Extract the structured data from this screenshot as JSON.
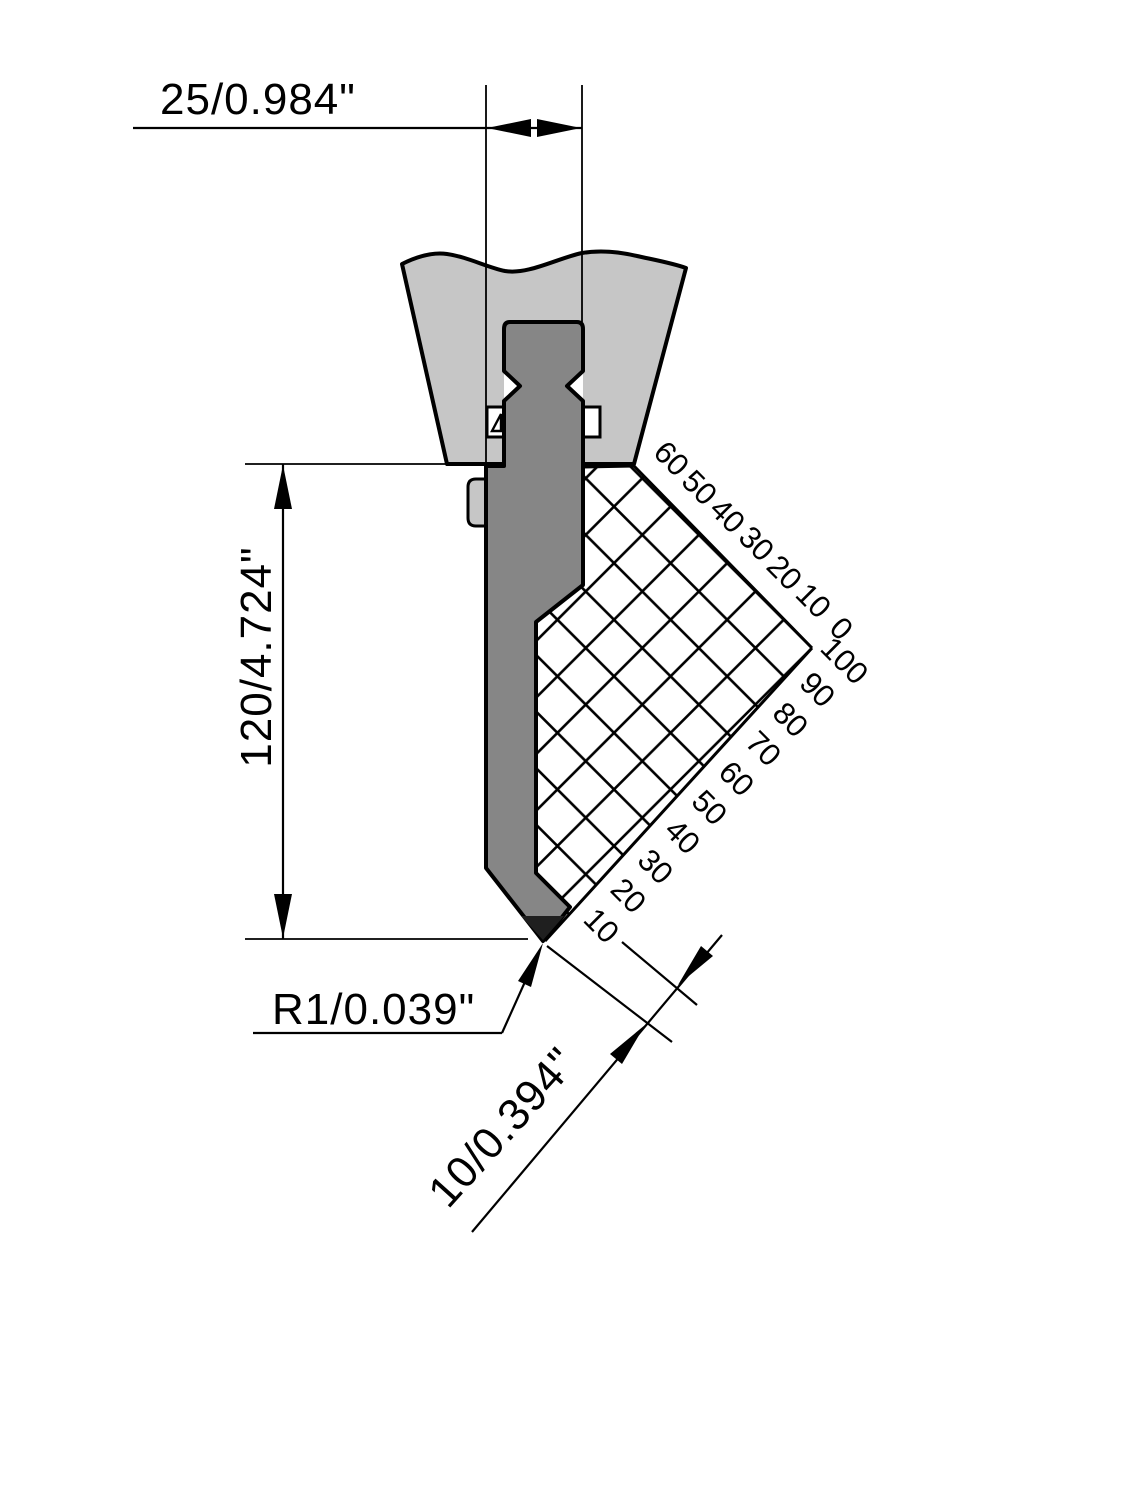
{
  "title": "Press brake punch technical drawing",
  "dimensions": {
    "width_top": "25/0.984\"",
    "height_left": "120/4.724\"",
    "tip_radius": "R1/0.039\"",
    "pitch_diagonal": "10/0.394\""
  },
  "scales": {
    "top": [
      "60",
      "50",
      "40",
      "30",
      "20",
      "10",
      "0"
    ],
    "bottom": [
      "100",
      "90",
      "80",
      "70",
      "60",
      "50",
      "40",
      "30",
      "20",
      "10"
    ]
  },
  "colors": {
    "clamp": "#c6c6c6",
    "punch": "#868686",
    "tip": "#1f1f1f",
    "line": "#000000",
    "background": "#ffffff"
  }
}
